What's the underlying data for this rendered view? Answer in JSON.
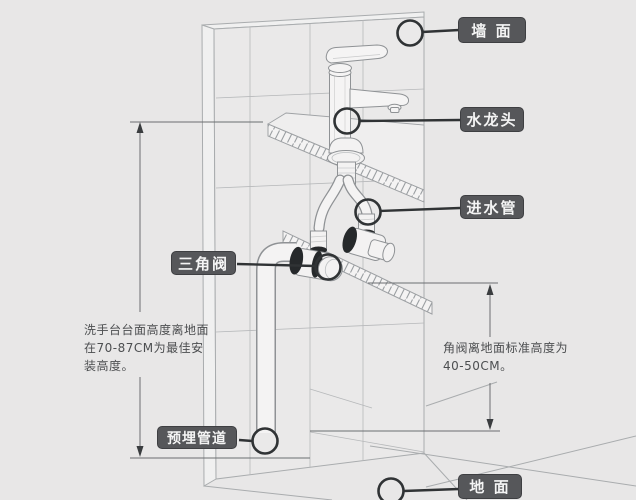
{
  "canvas": {
    "background": "#e8e7e7"
  },
  "labels": {
    "wall": {
      "text": "墙 面"
    },
    "faucet": {
      "text": "水龙头"
    },
    "inlet_pipe": {
      "text": "进水管"
    },
    "angle_valve": {
      "text": "三角阀"
    },
    "embedded_pipe": {
      "text": "预埋管道"
    },
    "floor": {
      "text": "地 面"
    }
  },
  "notes": {
    "counter_height": "洗手台台面高度离地面在70-87CM为最佳安装高度。",
    "valve_height": "角阀离地面标准高度为40-50CM。"
  },
  "measurements": {
    "counter_height_range": "70-87CM",
    "valve_height_range": "40-50CM"
  },
  "colors": {
    "background": "#e8e7e7",
    "label_background": "#56575a",
    "label_text": "#f4f4f4",
    "callout_line": "#303335",
    "line_art": "#9fa2a5",
    "dimension_line": "#6b6e71",
    "note_text": "#4c4e50"
  }
}
